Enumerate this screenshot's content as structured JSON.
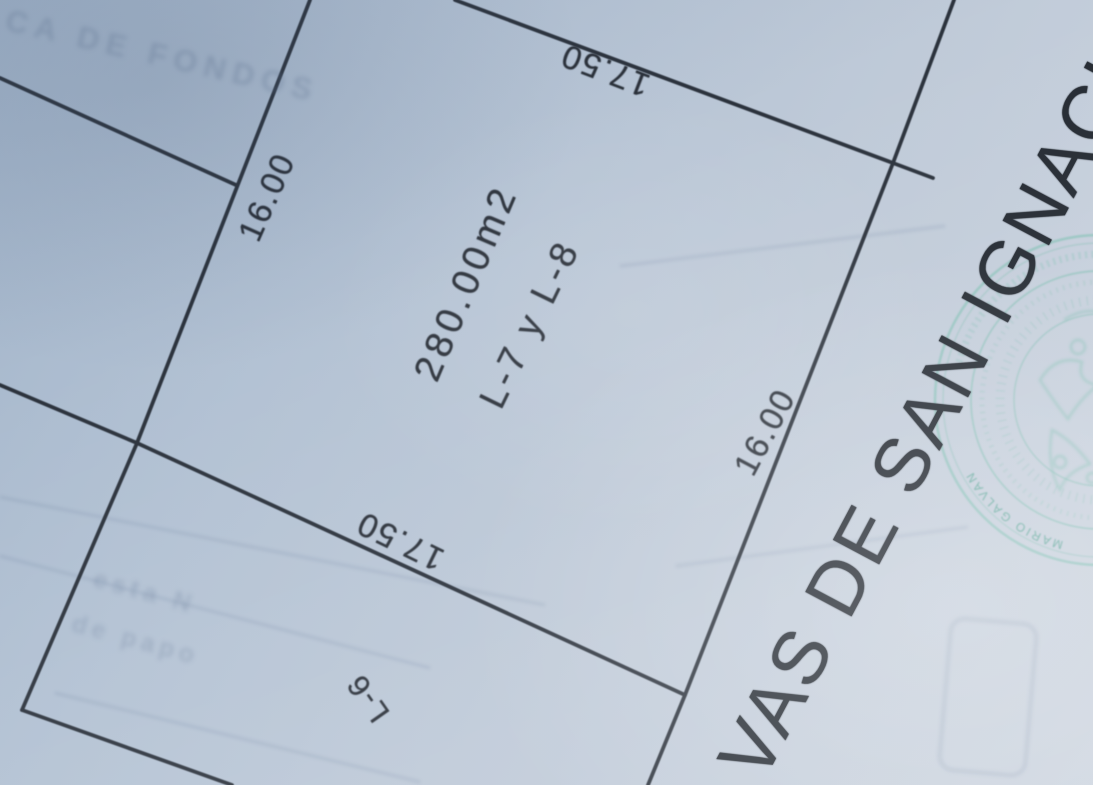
{
  "plan": {
    "dimensions": {
      "top": "17.50",
      "bottom": "17.50",
      "left": "16.00",
      "right": "16.00"
    },
    "area_label": "280.00m2",
    "lot_label": "L-7 y L-8",
    "adjacent_lot_label": "L-6",
    "subdivision_title": "VAS DE SAN IGNACIO"
  },
  "seal": {
    "name_text": "MARIO GALVAN"
  },
  "ghost_text": {
    "top": "CA DE FONDOS",
    "line1": "esta N",
    "line2": "de papo"
  },
  "colors": {
    "paper_dark": "#a4b6cb",
    "paper_light": "#ccd4df",
    "ink": "#2a3039",
    "seal_teal": "#7fbfb2",
    "ghost_blue": "#607492"
  }
}
